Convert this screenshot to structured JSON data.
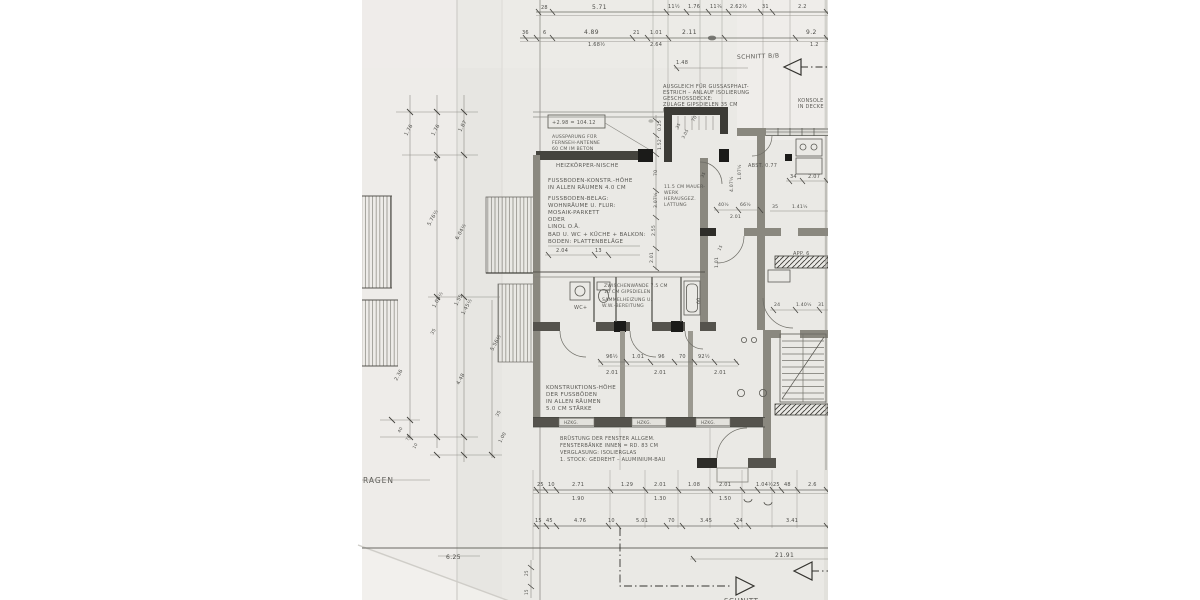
{
  "sheet": {
    "section_label_top": "SCHNITT B/B",
    "section_label_bottom": "SCHNITT",
    "garagen_label": "GARAGEN",
    "level_box": "+2.98 = 104.12",
    "abst_label": "ABST. 0.77",
    "app_label": "APP. 6",
    "wc_label": "WC+",
    "hzkg_label": "HZKG.",
    "total_dim": "21.91",
    "garagen_dim": "6.25",
    "dim_148": "1.48"
  },
  "notes": {
    "top_block": [
      "AUSGLEICH FÜR GUSSASPHALT-",
      "ESTRICH  –  ANLAUF ISOLIERUNG",
      "GESCHOSSDECKE:",
      "ZULAGE GIPSDIELEN 35 CM",
      "ÜBER FUSSBODEN"
    ],
    "konsole": [
      "KONSOLE",
      "IN DECKE"
    ],
    "antenne": [
      "AUSSPARUNG FÜR",
      "FERNSEH-ANTENNE",
      "60 CM IM BETON"
    ],
    "heiznische": "HEIZKÖRPER-NISCHE",
    "fussboden_p1": [
      "FUSSBODEN-KONSTR.-HÖHE",
      "IN ALLEN RÄUMEN 4.0 CM"
    ],
    "fussboden_p2": [
      "FUSSBODEN-BELAG:",
      "WOHNRÄUME U. FLUR:",
      "MOSAIK-PARKETT",
      "ODER",
      "LINOL O.Ä.",
      "BAD U. WC + KÜCHE + BALKON:",
      "BODEN: PLATTENBELÄGE"
    ],
    "mauerwerk": [
      "11.5 CM MAUER-",
      "WERK",
      "HERAUSGEZ.",
      "LATTUNG"
    ],
    "zwischenwaende": [
      "ZWISCHENWÄNDE 7.5 CM",
      "10 CM GIPSDIELEN",
      "SAMMELHEIZUNG U.",
      "W.W.-BEREITUNG"
    ],
    "konstruktion": [
      "KONSTRUKTIONS-HÖHE",
      "DER FUSSBÖDEN",
      "IN ALLEN RÄUMEN",
      "5.0 CM STÄRKE"
    ],
    "bruestung": [
      "BRÜSTUNG DER FENSTER ALLGEM.",
      "FENSTERBÄNKE INNEN = RD. 83 CM",
      "VERGLASUNG: ISOLIERGLAS",
      "1. STOCK: GEDREHT – ALUMINIUM-BAU"
    ]
  },
  "dims": {
    "top1": [
      "28",
      "5.71",
      "11½",
      "1.76",
      "11¾",
      "2.62½",
      "31",
      "2.2"
    ],
    "top2": [
      "36",
      "6",
      "4.89",
      "1.68½",
      "21",
      "1.01",
      "2.64",
      "2.11",
      "9.2",
      "1.2"
    ],
    "left": [
      "1.76",
      "1.76",
      "1.87",
      "41",
      "5.76½",
      "6.04½",
      "1.08½",
      "1.55",
      "1.45½",
      "35",
      "2.36",
      "4.48",
      "5.56½",
      "35",
      "1.00",
      "40",
      "76",
      "10"
    ],
    "mid": [
      "96½",
      "1.01",
      "96",
      "70",
      "92½",
      "2.01",
      "2.01",
      "2.01"
    ],
    "rightcol": [
      "0.25",
      "1.52",
      "70",
      "3.07½",
      "2.55",
      "2.01"
    ],
    "misc": {
      "d204": "2.04",
      "d13": "13",
      "d4075": "4.07½",
      "d1075": "1.07½",
      "d70a": "70",
      "d35a": "35",
      "d405": "40½",
      "d665": "66½",
      "d201": "2.01",
      "d101": "1.01",
      "d15": "15",
      "d34": "34",
      "d207": "2.07",
      "d35b": "35",
      "d1415": "1.41½",
      "d24": "24",
      "d1405": "1.40½",
      "d31": "31",
      "d305": "3.05",
      "d35c": "35",
      "d60": "60"
    },
    "bottom1": [
      "25",
      "10",
      "2.71",
      "1.29",
      "2.01",
      "1.08",
      "2.01",
      "1.04½",
      "25",
      "48",
      "2.6"
    ],
    "bottom1b": [
      "1.90",
      "1.30",
      "1.50"
    ],
    "bottom2": [
      "15",
      "45",
      "4.76",
      "10",
      "5.01",
      "70",
      "3.45",
      "24",
      "3.41"
    ],
    "side": [
      "25",
      "15"
    ]
  }
}
